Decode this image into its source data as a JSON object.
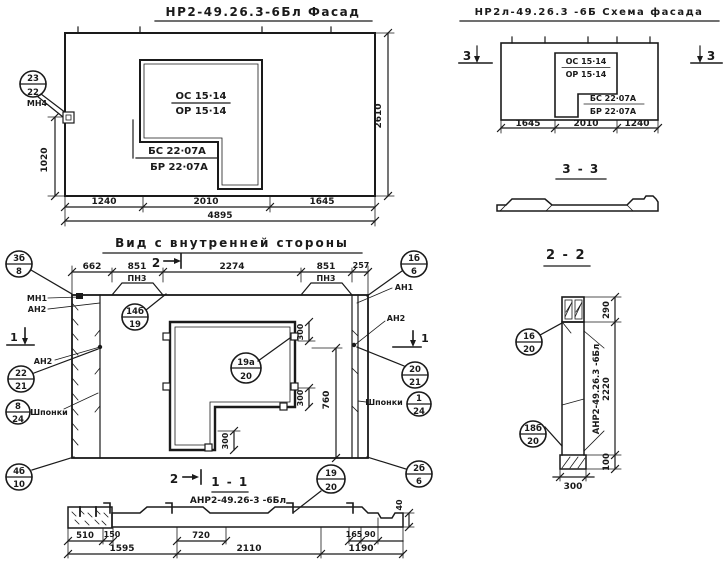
{
  "colors": {
    "ink": "#1a1a1a",
    "paper": "#ffffff"
  },
  "facade": {
    "title": "НР2-49.26.3-6Бл  Фасад",
    "opening_mark_top": "ОС 15·14",
    "opening_mark_bot": "ОР 15·14",
    "block_mark_top": "БС 22·07А",
    "block_mark_bot": "БР 22·07А",
    "callout_pos": "23",
    "callout_sheet": "22",
    "callout_label": "МН4",
    "dim_marker": "1020",
    "dim_height": "2610",
    "dim_w1": "1240",
    "dim_w2": "2010",
    "dim_w3": "1645",
    "dim_total": "4895"
  },
  "schema": {
    "title": "НР2л-49.26.3 -6Б  Схема фасада",
    "opening_mark_top": "ОС 15·14",
    "opening_mark_bot": "ОР 15·14",
    "block_mark_top": "БС 22·07А",
    "block_mark_bot": "БР 22·07А",
    "dim_w1": "1645",
    "dim_w2": "2010",
    "dim_w3": "1240",
    "section_mark": "3"
  },
  "section33": {
    "title": "3 - 3"
  },
  "section22": {
    "title": "2 - 2",
    "panel_label": "АНР2-49.26.3 -6Бл",
    "callout_top_pos": "16",
    "callout_top_sheet": "20",
    "callout_bot_pos": "18б",
    "callout_bot_sheet": "20",
    "dim_top": "290",
    "dim_mid": "2220",
    "dim_bot": "100",
    "dim_width": "300"
  },
  "inner": {
    "title": "Вид с внутренней стороны",
    "dim_t1": "662",
    "dim_t2": "851",
    "dim_t3": "2274",
    "dim_t4": "851",
    "dim_t5": "257",
    "pn3": "ПН3",
    "mark2": "2",
    "mark1": "1",
    "mn1": "МН1",
    "an2": "АН2",
    "an1": "АН1",
    "shponki": "Шпонки",
    "c_3b_pos": "3б",
    "c_3b_sheet": "8",
    "c_22_pos": "22",
    "c_22_sheet": "21",
    "c_8_pos": "8",
    "c_8_sheet": "24",
    "c_4b_pos": "4б",
    "c_4b_sheet": "10",
    "c_14b_pos": "14б",
    "c_14b_sheet": "19",
    "c_19a_pos": "19а",
    "c_19a_sheet": "20",
    "c_1b_pos": "1б",
    "c_1b_sheet": "6",
    "c_20_pos": "20",
    "c_20_sheet": "21",
    "c_1_pos": "1",
    "c_1_sheet": "24",
    "c_2b_pos": "2б",
    "c_2b_sheet": "6",
    "dim_300": "300",
    "dim_760": "760"
  },
  "section11": {
    "title": "1 - 1",
    "label": "АНР2-49.26-3 -6Бл",
    "c_19_pos": "19",
    "c_19_sheet": "20",
    "dim_510": "510",
    "dim_150": "150",
    "dim_720": "720",
    "dim_165": "165",
    "dim_90": "90",
    "dim_40": "40",
    "dim_b1": "1595",
    "dim_b2": "2110",
    "dim_b3": "1190"
  }
}
